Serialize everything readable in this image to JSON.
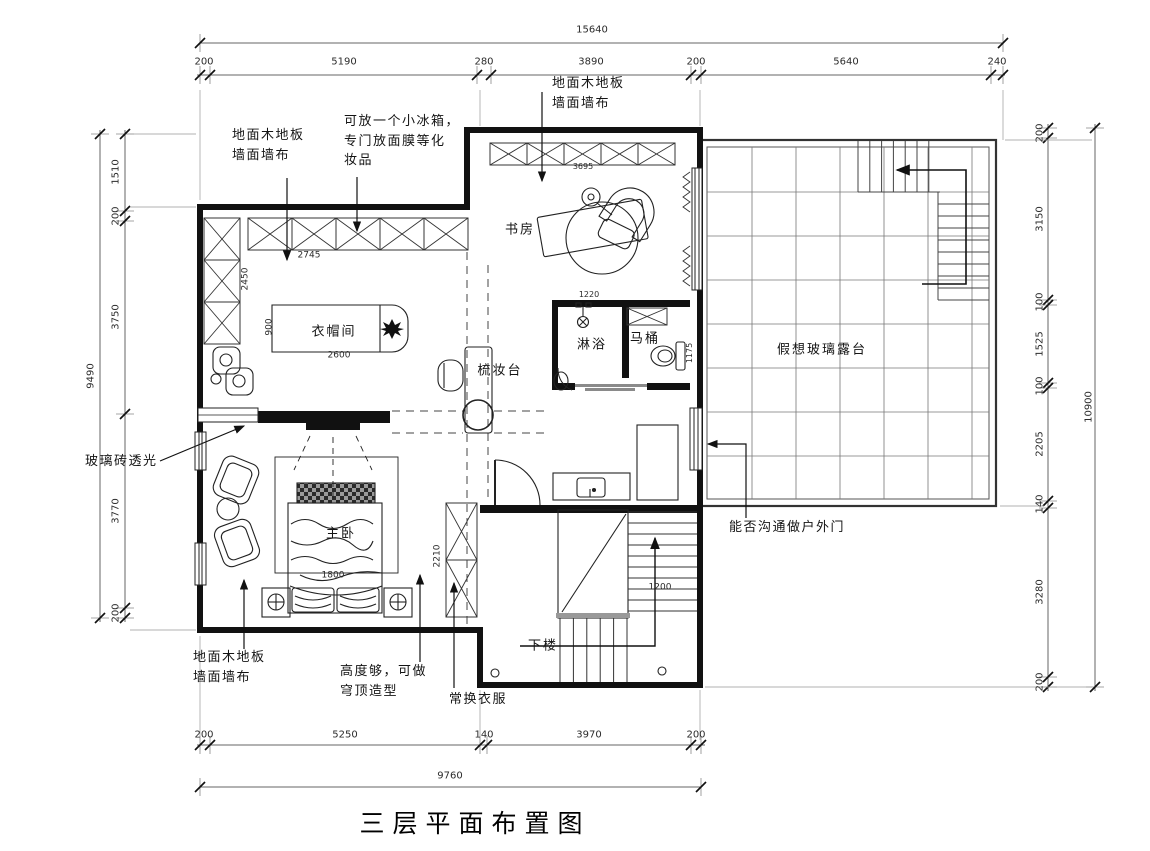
{
  "title": "三层平面布置图",
  "colors": {
    "line": "#1a1a1a",
    "dim_line": "#666666",
    "paper": "#ffffff"
  },
  "rooms": [
    {
      "name": "room-label-study",
      "text": "书房",
      "x": 520,
      "y": 230
    },
    {
      "name": "room-label-cloakroom",
      "text": "衣帽间",
      "x": 334,
      "y": 332
    },
    {
      "name": "room-label-dressing-table",
      "text": "梳妆台",
      "x": 500,
      "y": 371
    },
    {
      "name": "room-label-shower",
      "text": "淋浴",
      "x": 592,
      "y": 345
    },
    {
      "name": "room-label-toilet",
      "text": "马桶",
      "x": 645,
      "y": 339
    },
    {
      "name": "room-label-terrace",
      "text": "假想玻璃露台",
      "x": 822,
      "y": 350
    },
    {
      "name": "room-label-master-bedroom",
      "text": "主卧",
      "x": 341,
      "y": 534
    },
    {
      "name": "room-label-stairs-down",
      "text": "下楼",
      "x": 543,
      "y": 646
    }
  ],
  "annotations": [
    {
      "name": "note-wood-floor-top",
      "text": "地面木地板\n墙面墙布",
      "x": 232,
      "y": 126
    },
    {
      "name": "note-mini-fridge",
      "text": "可放一个小冰箱，\n专门放面膜等化\n妆品",
      "x": 344,
      "y": 112
    },
    {
      "name": "note-wood-floor-study",
      "text": "地面木地板\n墙面墙布",
      "x": 552,
      "y": 74
    },
    {
      "name": "note-glass-brick",
      "text": "玻璃砖透光",
      "x": 85,
      "y": 452
    },
    {
      "name": "note-outdoor-door",
      "text": "能否沟通做户外门",
      "x": 729,
      "y": 518
    },
    {
      "name": "note-wood-floor-bedroom",
      "text": "地面木地板\n墙面墙布",
      "x": 193,
      "y": 648
    },
    {
      "name": "note-dome-ceiling",
      "text": "高度够，可做\n穹顶造型",
      "x": 340,
      "y": 662
    },
    {
      "name": "note-change-clothes",
      "text": "常换衣服",
      "x": 449,
      "y": 690
    }
  ],
  "dimensions": {
    "top": {
      "overall": "15640",
      "segments": [
        "200",
        "5190",
        "280",
        "3890",
        "200",
        "5640",
        "240"
      ]
    },
    "bottom": {
      "overall": "9760",
      "segments": [
        "200",
        "5250",
        "140",
        "3970",
        "200"
      ]
    },
    "left": {
      "overall": "9490",
      "segments": [
        "1510",
        "200",
        "3750",
        "3770",
        "200"
      ]
    },
    "right": {
      "overall": "10900",
      "segments": [
        "200",
        "3150",
        "100",
        "1525",
        "100",
        "2205",
        "140",
        "3280",
        "200"
      ]
    },
    "interior": [
      "2745",
      "2450",
      "900",
      "2600",
      "3695",
      "1220",
      "1175",
      "2210",
      "1800",
      "1200"
    ]
  },
  "dim_labels": [
    {
      "name": "dim-top-15640",
      "text": "15640",
      "x": 592,
      "y": 30
    },
    {
      "name": "dim-top-200-left",
      "text": "200",
      "x": 204,
      "y": 62
    },
    {
      "name": "dim-top-5190",
      "text": "5190",
      "x": 344,
      "y": 62
    },
    {
      "name": "dim-top-280",
      "text": "280",
      "x": 484,
      "y": 62
    },
    {
      "name": "dim-top-3890",
      "text": "3890",
      "x": 591,
      "y": 62
    },
    {
      "name": "dim-top-200-mid",
      "text": "200",
      "x": 696,
      "y": 62
    },
    {
      "name": "dim-top-5640",
      "text": "5640",
      "x": 846,
      "y": 62
    },
    {
      "name": "dim-top-240",
      "text": "240",
      "x": 997,
      "y": 62
    },
    {
      "name": "dim-bottom-200-l",
      "text": "200",
      "x": 204,
      "y": 735
    },
    {
      "name": "dim-bottom-5250",
      "text": "5250",
      "x": 345,
      "y": 735
    },
    {
      "name": "dim-bottom-140",
      "text": "140",
      "x": 484,
      "y": 735
    },
    {
      "name": "dim-bottom-3970",
      "text": "3970",
      "x": 589,
      "y": 735
    },
    {
      "name": "dim-bottom-200-r",
      "text": "200",
      "x": 696,
      "y": 735
    },
    {
      "name": "dim-bottom-9760",
      "text": "9760",
      "x": 450,
      "y": 776
    },
    {
      "name": "dim-left-1510",
      "text": "1510",
      "x": 116,
      "y": 172,
      "rot": true
    },
    {
      "name": "dim-left-200-top",
      "text": "200",
      "x": 116,
      "y": 216,
      "rot": true
    },
    {
      "name": "dim-left-3750",
      "text": "3750",
      "x": 116,
      "y": 317,
      "rot": true
    },
    {
      "name": "dim-left-3770",
      "text": "3770",
      "x": 116,
      "y": 511,
      "rot": true
    },
    {
      "name": "dim-left-200-bot",
      "text": "200",
      "x": 116,
      "y": 613,
      "rot": true
    },
    {
      "name": "dim-left-9490",
      "text": "9490",
      "x": 91,
      "y": 376,
      "rot": true
    },
    {
      "name": "dim-right-200-top",
      "text": "200",
      "x": 1040,
      "y": 133,
      "rot": true
    },
    {
      "name": "dim-right-3150",
      "text": "3150",
      "x": 1040,
      "y": 219,
      "rot": true
    },
    {
      "name": "dim-right-100-a",
      "text": "100",
      "x": 1040,
      "y": 302,
      "rot": true
    },
    {
      "name": "dim-right-1525",
      "text": "1525",
      "x": 1040,
      "y": 344,
      "rot": true
    },
    {
      "name": "dim-right-100-b",
      "text": "100",
      "x": 1040,
      "y": 386,
      "rot": true
    },
    {
      "name": "dim-right-2205",
      "text": "2205",
      "x": 1040,
      "y": 444,
      "rot": true
    },
    {
      "name": "dim-right-140",
      "text": "140",
      "x": 1040,
      "y": 504,
      "rot": true
    },
    {
      "name": "dim-right-3280",
      "text": "3280",
      "x": 1040,
      "y": 592,
      "rot": true
    },
    {
      "name": "dim-right-200-bot",
      "text": "200",
      "x": 1040,
      "y": 682,
      "rot": true
    },
    {
      "name": "dim-right-10900",
      "text": "10900",
      "x": 1089,
      "y": 407,
      "rot": true
    },
    {
      "name": "dim-int-2745",
      "text": "2745",
      "x": 309,
      "y": 256,
      "size": 9
    },
    {
      "name": "dim-int-2450",
      "text": "2450",
      "x": 246,
      "y": 279,
      "rot": true,
      "size": 9
    },
    {
      "name": "dim-int-900",
      "text": "900",
      "x": 270,
      "y": 327,
      "rot": true,
      "size": 9
    },
    {
      "name": "dim-int-2600",
      "text": "2600",
      "x": 339,
      "y": 356,
      "size": 9
    },
    {
      "name": "dim-int-3695",
      "text": "3695",
      "x": 583,
      "y": 167,
      "size": 8
    },
    {
      "name": "dim-int-1220",
      "text": "1220",
      "x": 589,
      "y": 295,
      "size": 8
    },
    {
      "name": "dim-int-1175",
      "text": "1175",
      "x": 690,
      "y": 353,
      "rot": true,
      "size": 8
    },
    {
      "name": "dim-int-2210",
      "text": "2210",
      "x": 438,
      "y": 556,
      "rot": true,
      "size": 9
    },
    {
      "name": "dim-int-1800",
      "text": "1800",
      "x": 333,
      "y": 576,
      "size": 9
    },
    {
      "name": "dim-int-1200",
      "text": "1200",
      "x": 660,
      "y": 588,
      "size": 9
    }
  ]
}
